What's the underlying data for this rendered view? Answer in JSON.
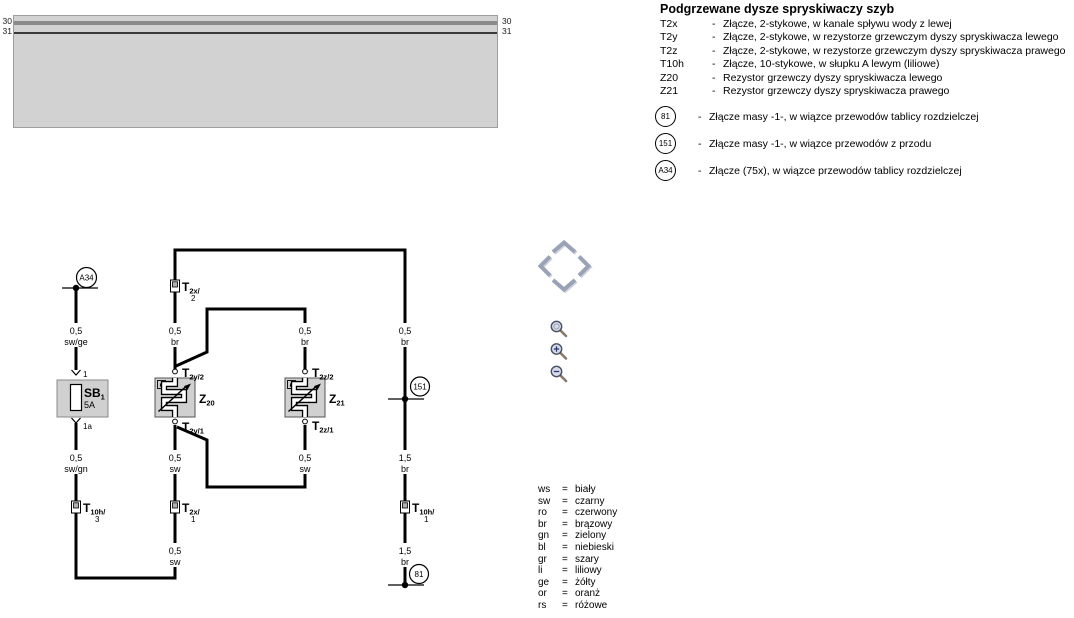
{
  "busbar": {
    "left_30": "30",
    "left_31": "31",
    "right_30": "30",
    "right_31": "31"
  },
  "legend": {
    "title": "Podgrzewane dysze spryskiwaczy szyb",
    "dash": "-",
    "items": [
      {
        "key": "T2x",
        "desc": "Złącze, 2-stykowe, w kanale spływu wody z lewej"
      },
      {
        "key": "T2y",
        "desc": "Złącze, 2-stykowe, w rezystorze grzewczym dyszy spryskiwacza lewego"
      },
      {
        "key": "T2z",
        "desc": "Złącze, 2-stykowe, w rezystorze grzewczym dyszy spryskiwacza prawego"
      },
      {
        "key": "T10h",
        "desc": "Złącze, 10-stykowe, w słupku A lewym (liliowe)"
      },
      {
        "key": "Z20",
        "desc": "Rezystor grzewczy dyszy spryskiwacza lewego"
      },
      {
        "key": "Z21",
        "desc": "Rezystor grzewczy dyszy spryskiwacza prawego"
      }
    ],
    "circle_items": [
      {
        "key": "81",
        "desc": "Złącze masy -1-, w wiązce przewodów tablicy rozdzielczej"
      },
      {
        "key": "151",
        "desc": "Złącze masy -1-, w wiązce przewodów z przodu"
      },
      {
        "key": "A34",
        "desc": "Złącze (75x), w wiązce przewodów tablicy rozdzielczej"
      }
    ]
  },
  "color_legend": {
    "eq": "=",
    "items": [
      {
        "abbr": "ws",
        "name": "biały"
      },
      {
        "abbr": "sw",
        "name": "czarny"
      },
      {
        "abbr": "ro",
        "name": "czerwony"
      },
      {
        "abbr": "br",
        "name": "brązowy"
      },
      {
        "abbr": "gn",
        "name": "zielony"
      },
      {
        "abbr": "bl",
        "name": "niebieski"
      },
      {
        "abbr": "gr",
        "name": "szary"
      },
      {
        "abbr": "li",
        "name": "liliowy"
      },
      {
        "abbr": "ge",
        "name": "żółty"
      },
      {
        "abbr": "or",
        "name": "oranż"
      },
      {
        "abbr": "rs",
        "name": "różowe"
      }
    ]
  },
  "circuit": {
    "a34_label": "A34",
    "g151_label": "151",
    "g81_label": "81",
    "fuse": {
      "name": "SB",
      "sub": "1",
      "rating": "5A",
      "pin_top": "1",
      "pin_bottom": "1a"
    },
    "z20": {
      "name": "Z",
      "sub": "20"
    },
    "z21": {
      "name": "Z",
      "sub": "21"
    },
    "connectors": {
      "t2x2": {
        "main": "T",
        "sub": "2x/",
        "pin": "2"
      },
      "t2x1": {
        "main": "T",
        "sub": "2x/",
        "pin": "1"
      },
      "t10h3": {
        "main": "T",
        "sub": "10h/",
        "pin": "3"
      },
      "t10h1": {
        "main": "T",
        "sub": "10h/",
        "pin": "1"
      },
      "t2y2": {
        "main": "T",
        "sub": "2y/2"
      },
      "t2y1": {
        "main": "T",
        "sub": "2y/1"
      },
      "t2z2": {
        "main": "T",
        "sub": "2z/2"
      },
      "t2z1": {
        "main": "T",
        "sub": "2z/1"
      }
    },
    "wire_labels": [
      {
        "gauge": "0,5",
        "color": "sw/ge"
      },
      {
        "gauge": "0,5",
        "color": "sw/gn"
      },
      {
        "gauge": "0,5",
        "color": "br"
      },
      {
        "gauge": "0,5",
        "color": "br"
      },
      {
        "gauge": "0,5",
        "color": "br"
      },
      {
        "gauge": "0,5",
        "color": "sw"
      },
      {
        "gauge": "0,5",
        "color": "sw"
      },
      {
        "gauge": "1,5",
        "color": "br"
      },
      {
        "gauge": "0,5",
        "color": "sw"
      },
      {
        "gauge": "1,5",
        "color": "br"
      }
    ]
  },
  "colors": {
    "wire": "#000000",
    "panel_fill": "#d2d2d2",
    "line30": "#8a8a8a",
    "line31": "#3a3a3a",
    "component_fill": "#d0d0d0",
    "nav_arrow": "#9aa2b6"
  }
}
